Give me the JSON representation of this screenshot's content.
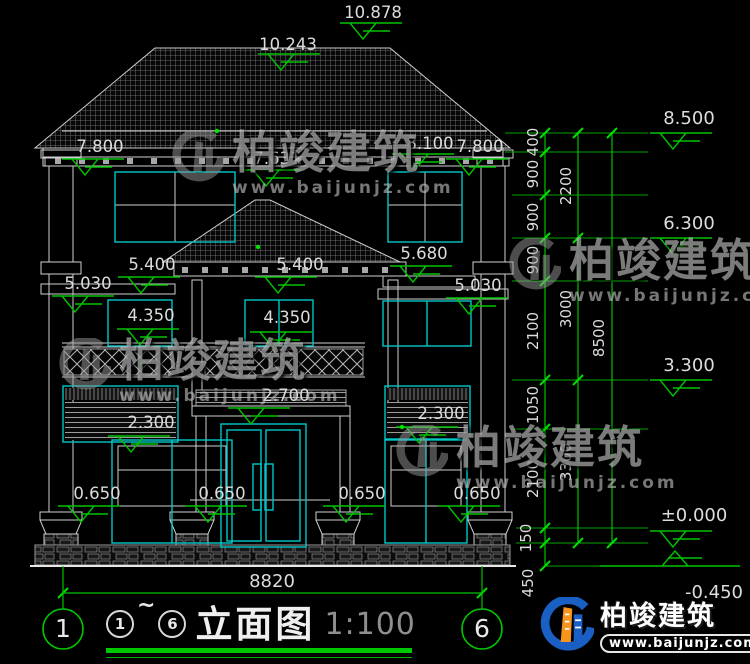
{
  "drawing": {
    "marks": {
      "ridge": "10.878",
      "roof_front": "10.243",
      "eave_top": "8.100",
      "parapet_left": "7.800",
      "parapet_right": "7.800",
      "eave_soffit": "7.631",
      "canopy_top": "5.680",
      "porch_eave_left": "5.400",
      "porch_eave_right": "5.400",
      "band_left": "5.030",
      "band_right": "5.030",
      "window_head_left": "4.350",
      "window_head_center": "4.350",
      "balcony_rail": "2.700",
      "louver_left": "2.300",
      "louver_right": "2.300",
      "sill_1": "0.650",
      "sill_2": "0.650",
      "sill_3": "0.650",
      "sill_4": "0.650"
    },
    "width_total": "8820"
  },
  "right_dims": {
    "chain_inner": [
      "400",
      "900",
      "900",
      "900",
      "2100",
      "1050",
      "2100",
      "150",
      "450"
    ],
    "chain_mid": [
      "2200",
      "3000",
      "3300"
    ],
    "chain_total": "8500",
    "levels": {
      "l8500": "8.500",
      "l6300": "6.300",
      "l3300": "3.300",
      "l0": "±0.000",
      "lm450": "-0.450"
    }
  },
  "titlebar": {
    "axis_left": "1",
    "axis_right": "6",
    "bubble_start": "1",
    "range_tilde": "~",
    "bubble_end": "6",
    "title": "立面图",
    "scale": "1:100"
  },
  "watermark": {
    "brand": "柏竣建筑",
    "url": "www.baijunjz.com"
  },
  "logo": {
    "brand": "柏竣建筑",
    "url": "www.baijunjz.com"
  }
}
